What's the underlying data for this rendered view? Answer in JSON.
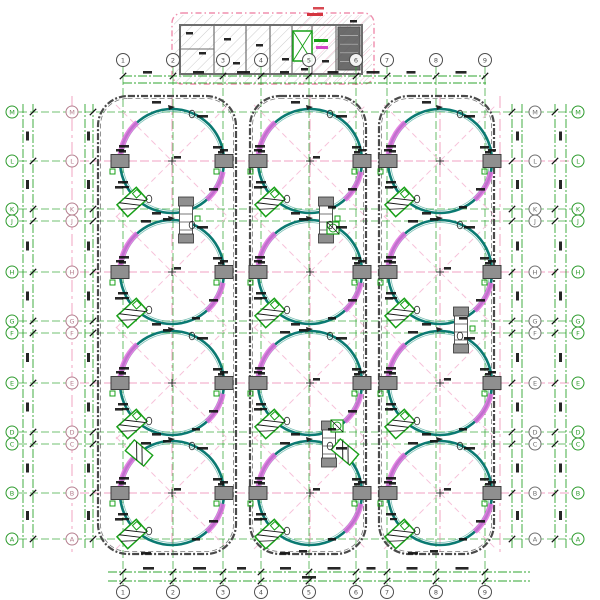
{
  "drawing": {
    "type": "cad-tank-farm-plan",
    "description": "Engineering site plan: pump house building at top, 3x4 grid of circular storage tanks inside rounded bund enclosures, green/pink structural grid with lettered and numbered axis bubbles and dimension chains",
    "canvas": {
      "w": 600,
      "h": 600,
      "bg": "#ffffff"
    },
    "colors": {
      "grid_green": "#2fa52f",
      "grid_pink": "#f09cc0",
      "center_pink": "#ee8fb4",
      "diag_pink": "#f6bcd6",
      "tank": "#0b7a72",
      "tank_inner": "#37a08f",
      "magenta": "#e16ede",
      "enclosure": "#4a4a4a",
      "block_fill": "#8f8f8f",
      "block_stroke": "#3c3c3c",
      "skid_green": "#18a018",
      "dim_black": "#141414",
      "bubble_green": "#2d9b2d",
      "bubble_gray": "#6f6f6f",
      "bubble_pink": "#b57f8f",
      "bubble_dark": "#4d4d4d",
      "wall_gray": "#6e6e6e",
      "hatch_gray": "#9a9a9a",
      "hatch_pink": "#f2a9c4",
      "equip_dark": "#5d5d5d",
      "room_green": "#17a017",
      "text_red": "#d4353f",
      "text_magenta": "#d445c8"
    },
    "column_grid": {
      "labels": [
        "1",
        "2",
        "3",
        "4",
        "5",
        "6",
        "7",
        "8",
        "9"
      ],
      "x": [
        123,
        173,
        223,
        261,
        309,
        356,
        387,
        436,
        485
      ],
      "top_bubble_y": 60,
      "bottom_bubble_y": 592,
      "line_top": 66,
      "line_bottom": 586
    },
    "row_grid": {
      "labels": [
        "M",
        "L",
        "K",
        "J",
        "H",
        "G",
        "F",
        "E",
        "D",
        "C",
        "B",
        "A"
      ],
      "y": [
        112,
        161,
        209,
        221,
        272,
        321,
        333,
        383,
        432,
        444,
        493,
        539
      ],
      "pink_idx": [
        1,
        4,
        7,
        10
      ],
      "left_bubble_x": [
        12,
        72
      ],
      "right_bubble_x": [
        535,
        578
      ],
      "line_left": 8,
      "line_right": 582
    },
    "tanks": {
      "col_x": [
        172,
        310,
        440
      ],
      "row_y": [
        161,
        272,
        383,
        493
      ],
      "radius": 52
    },
    "enclosures": [
      {
        "x1": 98,
        "x2": 236
      },
      {
        "x1": 250,
        "x2": 366
      },
      {
        "x1": 379,
        "x2": 494
      }
    ],
    "enclosure_y": {
      "y1": 96,
      "y2": 554,
      "rx": 30
    },
    "pink_vlines": [
      72,
      172,
      310,
      440,
      500
    ],
    "dims": {
      "top": {
        "ys": [
          76,
          83
        ],
        "x1": 123,
        "x2": 486
      },
      "bottom": {
        "ys": [
          572,
          581
        ],
        "x1": 108,
        "x2": 530
      },
      "left": {
        "xs": [
          23,
          33,
          85,
          93
        ],
        "y1": 104,
        "y2": 548
      },
      "right": {
        "xs": [
          512,
          522,
          555,
          566
        ],
        "y1": 104,
        "y2": 548
      }
    },
    "stairs": [
      [
        186,
        220
      ],
      [
        326,
        220
      ],
      [
        329,
        444
      ],
      [
        461,
        330
      ]
    ],
    "extra_skids": [
      {
        "x": 139,
        "y": 453,
        "rot": 40
      },
      {
        "x": 345,
        "y": 452,
        "rot": 40
      }
    ],
    "pumps": [
      [
        333,
        228
      ],
      [
        337,
        426
      ]
    ],
    "building": {
      "border": {
        "x": 172,
        "y": 13,
        "w": 202,
        "h": 71,
        "rx": 10
      },
      "wall": {
        "x": 180,
        "y": 25,
        "w": 182,
        "h": 49
      },
      "inner_walls_x": [
        214,
        246,
        270,
        292,
        312,
        336
      ],
      "equip_room": {
        "x": 338,
        "y": 27,
        "w": 22,
        "h": 43
      },
      "green_room": {
        "x": 293,
        "y": 31,
        "w": 19,
        "h": 30
      },
      "labels": {
        "green": [
          314,
          39,
          14
        ],
        "magenta": [
          316,
          46,
          12
        ],
        "red": [
          307,
          13,
          16
        ]
      },
      "black_marks": [
        [
          186,
          32
        ],
        [
          199,
          52
        ],
        [
          224,
          38
        ],
        [
          233,
          62
        ],
        [
          256,
          44
        ],
        [
          282,
          58
        ],
        [
          301,
          68
        ],
        [
          322,
          60
        ],
        [
          350,
          20
        ]
      ]
    },
    "tank_deco": {
      "blobs": [
        [
          -20,
          -60,
          9
        ],
        [
          24,
          -46,
          11
        ],
        [
          -55,
          -16,
          10
        ],
        [
          -53,
          -11,
          7
        ],
        [
          40,
          -15,
          9
        ],
        [
          44,
          -10,
          6
        ],
        [
          -57,
          25,
          8
        ],
        [
          36,
          27,
          9
        ],
        [
          -11,
          57,
          8
        ],
        [
          2,
          -5,
          7
        ],
        [
          -32,
          59,
          10
        ],
        [
          18,
          45,
          8
        ]
      ],
      "ellipses": [
        [
          20,
          -47
        ],
        [
          -23,
          38
        ]
      ],
      "arcs": [
        [
          132,
          178
        ],
        [
          -48,
          -12
        ]
      ]
    }
  }
}
